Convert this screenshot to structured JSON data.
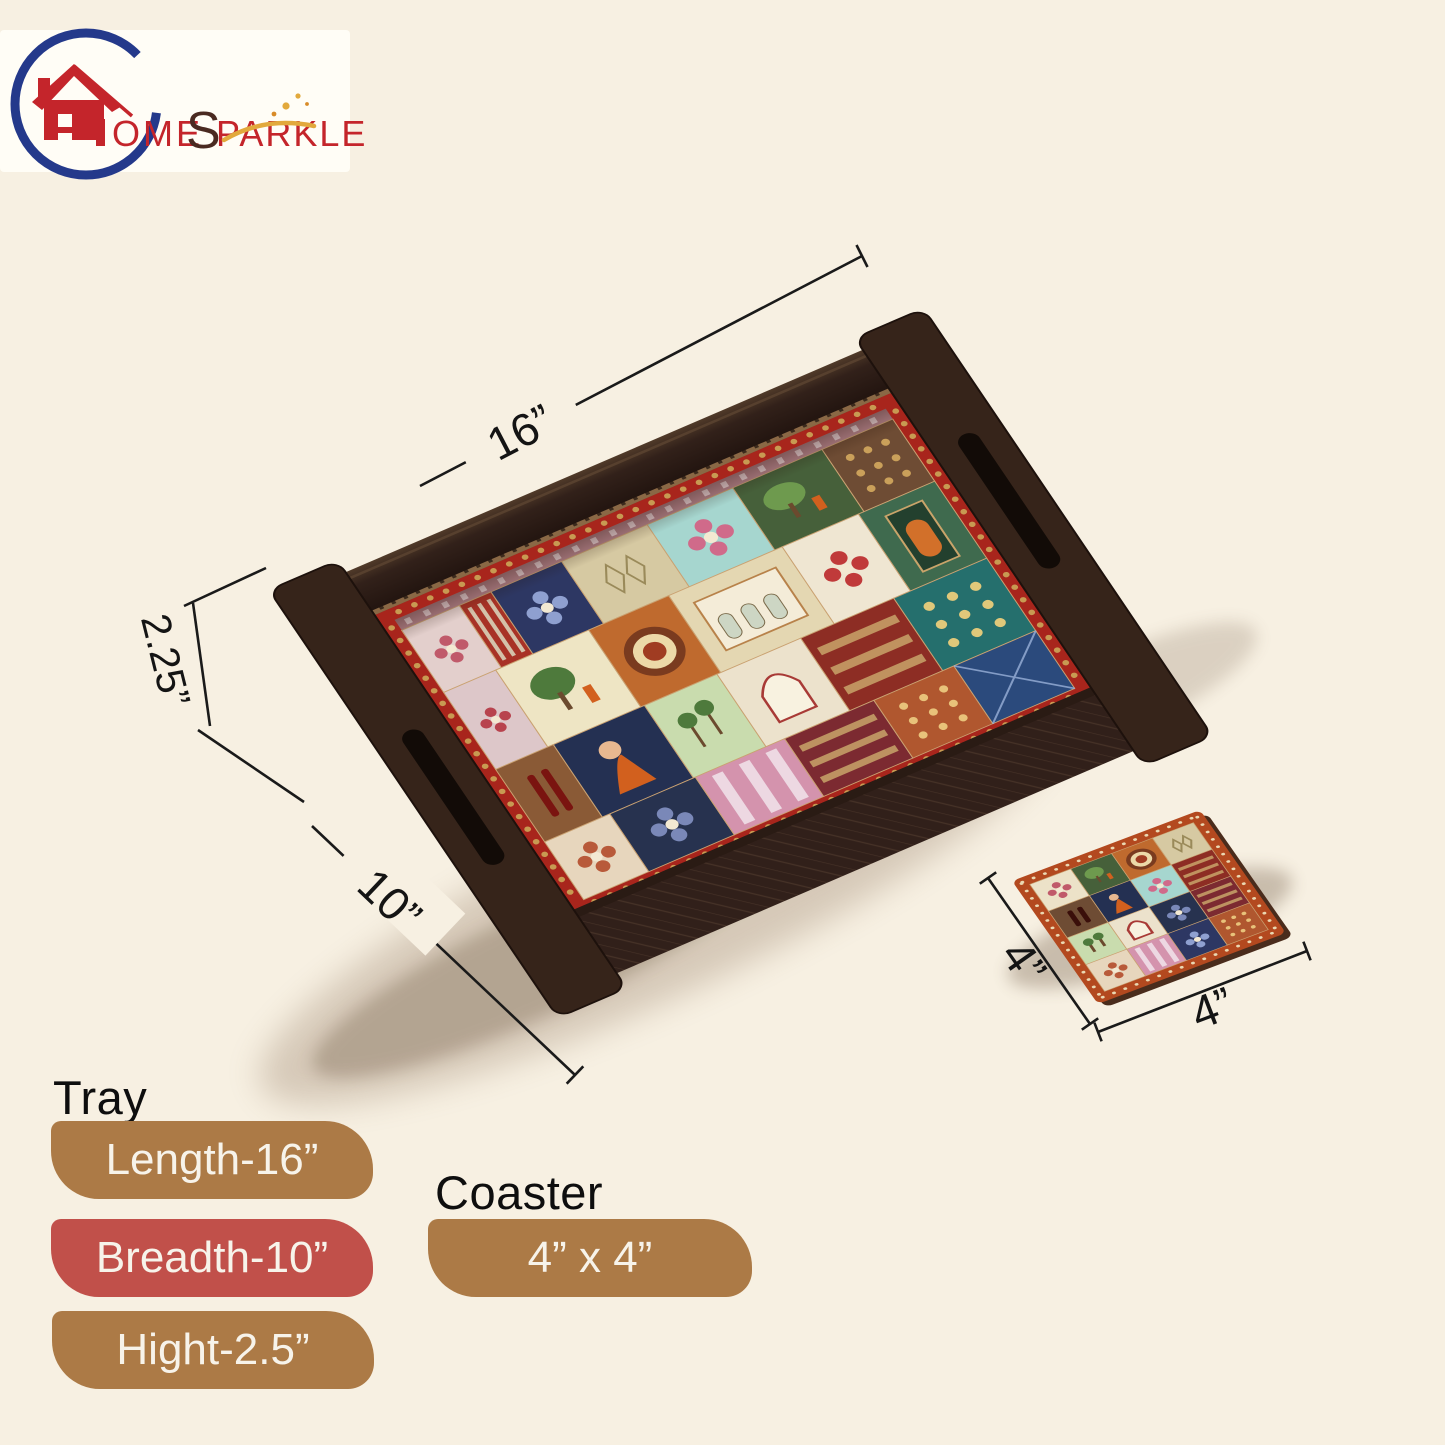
{
  "page": {
    "background": "#f7f0e2"
  },
  "logo": {
    "brand_prefix": "OME",
    "brand_s": "S",
    "brand_suffix": "PARKLE",
    "red": "#c4252b",
    "blue": "#24398b",
    "dark": "#4a2a21",
    "gold": "#e2a93c"
  },
  "dimension_labels": {
    "tray_length": "16”",
    "tray_height": "2.25”",
    "tray_breadth": "10”",
    "coaster_side": "4”",
    "coaster_front": "4”"
  },
  "product_text": {
    "tray_heading": "Tray",
    "coaster_heading": "Coaster",
    "tray_badges": [
      {
        "label": "Length-16”",
        "color": "#ac7a46"
      },
      {
        "label": "Breadth-10”",
        "color": "#c1504a"
      },
      {
        "label": "Hight-2.5”",
        "color": "#ac7a46"
      }
    ],
    "coaster_badge": {
      "label": "4” x 4”",
      "color": "#ac7a46"
    }
  },
  "tray": {
    "wood_dark": "#2a1b14",
    "wood_mid": "#36241a",
    "wood_light": "#57402e",
    "frame_red": "#a8251c",
    "frame_dot": "#c89a52",
    "inner_strip": "#8a6845",
    "strip_dash": "#3c2a1c",
    "band": {
      "fill": "#b5838b",
      "accent": "#e8d0d4"
    },
    "tiles": [
      {
        "x": 0,
        "y": 14,
        "w": 62,
        "h": 84,
        "fill": "#e3cfcc",
        "motif": "flower",
        "accent": "#c05a6a"
      },
      {
        "x": 62,
        "y": 14,
        "w": 34,
        "h": 84,
        "fill": "#a83226",
        "motif": "stripes",
        "accent": "#d8d0b8"
      },
      {
        "x": 96,
        "y": 14,
        "w": 76,
        "h": 84,
        "fill": "#2d3763",
        "motif": "flower",
        "accent": "#8fa0d0"
      },
      {
        "x": 172,
        "y": 14,
        "w": 92,
        "h": 84,
        "fill": "#d6c9a2",
        "motif": "ogee",
        "accent": "#9a8a5a"
      },
      {
        "x": 264,
        "y": 14,
        "w": 92,
        "h": 84,
        "fill": "#a6d6cf",
        "motif": "flower",
        "accent": "#d06a8a"
      },
      {
        "x": 356,
        "y": 14,
        "w": 96,
        "h": 84,
        "fill": "#46603a",
        "motif": "scene",
        "accent": "#6e9a4e"
      },
      {
        "x": 452,
        "y": 14,
        "w": 76,
        "h": 84,
        "fill": "#6e4c34",
        "motif": "dots9",
        "accent": "#caa05a"
      },
      {
        "x": 0,
        "y": 98,
        "w": 56,
        "h": 104,
        "fill": "#ddc7c9",
        "motif": "flower",
        "accent": "#b8434e"
      },
      {
        "x": 56,
        "y": 98,
        "w": 100,
        "h": 104,
        "fill": "#eee5c4",
        "motif": "scene",
        "accent": "#4e7a3c"
      },
      {
        "x": 156,
        "y": 98,
        "w": 86,
        "h": 104,
        "fill": "#bf6a2e",
        "motif": "mandala",
        "accent": "#7a3b1f"
      },
      {
        "x": 242,
        "y": 98,
        "w": 122,
        "h": 104,
        "fill": "#e4d7b2",
        "motif": "palace",
        "accent": "#b8824a"
      },
      {
        "x": 364,
        "y": 98,
        "w": 82,
        "h": 104,
        "fill": "#efe6d2",
        "motif": "flower",
        "accent": "#c03a3a"
      },
      {
        "x": 446,
        "y": 98,
        "w": 82,
        "h": 104,
        "fill": "#3f6a4e",
        "motif": "door",
        "accent": "#c9a46a"
      },
      {
        "x": 0,
        "y": 202,
        "w": 62,
        "h": 98,
        "fill": "#8a5a36",
        "motif": "bars",
        "accent": "#7a1410"
      },
      {
        "x": 62,
        "y": 202,
        "w": 98,
        "h": 98,
        "fill": "#243052",
        "motif": "figure",
        "accent": "#d2601e"
      },
      {
        "x": 160,
        "y": 202,
        "w": 78,
        "h": 98,
        "fill": "#c9dcae",
        "motif": "palms",
        "accent": "#4e7a3c"
      },
      {
        "x": 238,
        "y": 202,
        "w": 90,
        "h": 98,
        "fill": "#ece2cc",
        "motif": "arch",
        "accent": "#a83a36"
      },
      {
        "x": 328,
        "y": 202,
        "w": 100,
        "h": 98,
        "fill": "#8d2d24",
        "motif": "carpet",
        "accent": "#c9a46a"
      },
      {
        "x": 428,
        "y": 202,
        "w": 100,
        "h": 98,
        "fill": "#256f6d",
        "motif": "dots9",
        "accent": "#e0c87a"
      },
      {
        "x": 0,
        "y": 300,
        "w": 70,
        "h": 78,
        "fill": "#e7d6bd",
        "motif": "flower",
        "accent": "#b85a3a"
      },
      {
        "x": 70,
        "y": 300,
        "w": 92,
        "h": 78,
        "fill": "#27324f",
        "motif": "flower",
        "accent": "#7a88b8"
      },
      {
        "x": 162,
        "y": 300,
        "w": 96,
        "h": 78,
        "fill": "#d493ad",
        "motif": "stripes",
        "accent": "#f0e0e8"
      },
      {
        "x": 258,
        "y": 300,
        "w": 96,
        "h": 78,
        "fill": "#7c2a31",
        "motif": "carpet",
        "accent": "#c9a46a"
      },
      {
        "x": 354,
        "y": 300,
        "w": 86,
        "h": 78,
        "fill": "#b0572f",
        "motif": "dots9",
        "accent": "#e8c27a"
      },
      {
        "x": 440,
        "y": 300,
        "w": 88,
        "h": 78,
        "fill": "#2b4a7c",
        "motif": "lattice",
        "accent": "#9ab0d8"
      }
    ]
  },
  "coaster": {
    "border": "#b3491f",
    "edge": "#4a2c1c",
    "dot": "#ead8b2",
    "tiles": [
      {
        "fill": "#ece2c8",
        "motif": "flower",
        "accent": "#c05a6a"
      },
      {
        "fill": "#46603a",
        "motif": "scene",
        "accent": "#6e9a4e"
      },
      {
        "fill": "#bf6a2e",
        "motif": "mandala",
        "accent": "#7a3b1f"
      },
      {
        "fill": "#d6c9a2",
        "motif": "ogee",
        "accent": "#9a8a5a"
      },
      {
        "fill": "#6e4c34",
        "motif": "bars",
        "accent": "#3a0f0a"
      },
      {
        "fill": "#243052",
        "motif": "figure",
        "accent": "#d2601e"
      },
      {
        "fill": "#a6d6cf",
        "motif": "flower",
        "accent": "#d06a8a"
      },
      {
        "fill": "#8d2d24",
        "motif": "carpet",
        "accent": "#c9a46a"
      },
      {
        "fill": "#c9dcae",
        "motif": "palms",
        "accent": "#4e7a3c"
      },
      {
        "fill": "#ece2cc",
        "motif": "arch",
        "accent": "#a83a36"
      },
      {
        "fill": "#27324f",
        "motif": "flower",
        "accent": "#7a88b8"
      },
      {
        "fill": "#7c2a31",
        "motif": "carpet",
        "accent": "#c9a46a"
      },
      {
        "fill": "#e7d6bd",
        "motif": "flower",
        "accent": "#b85a3a"
      },
      {
        "fill": "#d493ad",
        "motif": "stripes",
        "accent": "#f0e0e8"
      },
      {
        "fill": "#2d3763",
        "motif": "flower",
        "accent": "#8fa0d0"
      },
      {
        "fill": "#b0572f",
        "motif": "dots9",
        "accent": "#e8c27a"
      }
    ]
  }
}
